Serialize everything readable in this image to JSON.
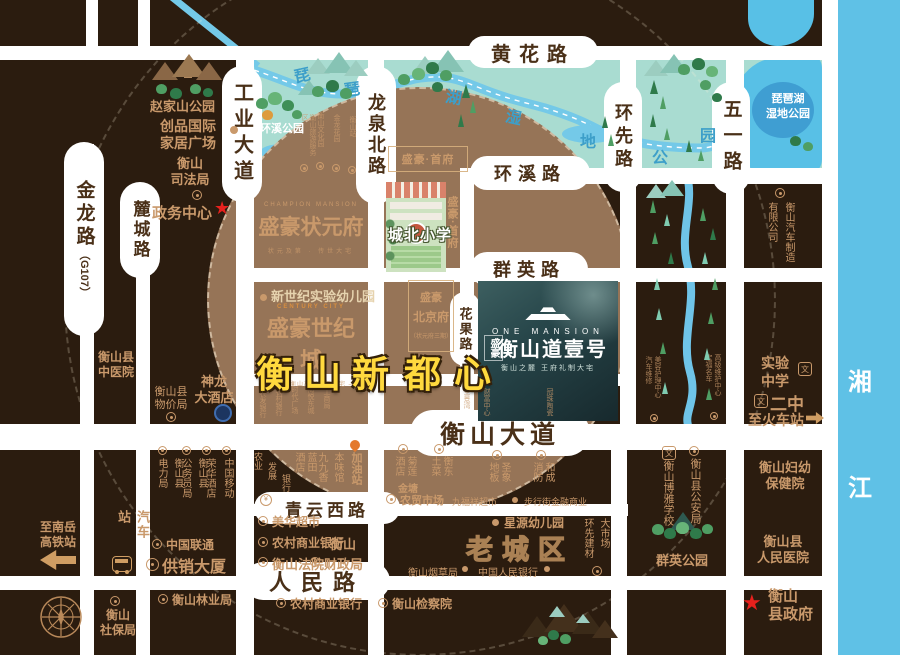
{
  "colors": {
    "bg": "#2b1c0f",
    "road": "#ffffff",
    "disc": "#967457",
    "gold": "#c9996b",
    "yellow": "#ffd93e",
    "wetland": "#a9dcd1",
    "river": "#74c9e8",
    "lake": "#58c0e6",
    "xiang": "#5fc1e6",
    "panel": "#1d3438",
    "red": "#e8211d",
    "orange": "#e4792c"
  },
  "roads": {
    "jinlong": "金龙路",
    "jinlong_sub": "（G107）",
    "lucheng": "麓城路",
    "gongye": "工业大道",
    "longquanbei": "龙泉北路",
    "huanxian": "环先路",
    "wuyi": "五一路",
    "huanghua": "黄花路",
    "huanxi": "环溪路",
    "qunying": "群英路",
    "dadao": "衡山大道",
    "qingyunxi": "青云西路",
    "renmin": "人民路",
    "huaguo": "花果路"
  },
  "river_labels": {
    "xiang": "湘",
    "jiang": "江"
  },
  "wetland": {
    "park": "环溪公园",
    "lake_line1": "琵琶湖",
    "lake_line2": "湿地公园",
    "chars": [
      "琵",
      "琶",
      "湖",
      "湿",
      "地",
      "公",
      "园"
    ]
  },
  "headline": {
    "l": "衡山新",
    "r": "都心"
  },
  "properties": {
    "shoufu_box": "盛豪·首府",
    "shoufu_side": "盛豪·首府",
    "champion_en": "CHAMPION MANSION",
    "champion": "盛豪状元府",
    "champion_sub": "状元及第 · 传世大宅",
    "kindergarten": "新世纪实验幼儿园",
    "century_en": "CENTURY CITY",
    "century": "盛豪世纪城",
    "century_sub": "— 献给衡山高端改善大宅 —",
    "beijing_1": "盛豪",
    "beijing_2": "北京府",
    "beijing_3": "（状元府三期）",
    "om_en": "ONE MANSION",
    "om_brand": "盛豪",
    "om_name": "衡山道壹号",
    "om_sub": "衡山之麓 王府礼制大宅",
    "school": "城北小学"
  },
  "poi": {
    "zhaojiashan": "赵家山公园",
    "chuangpin_1": "创品国际",
    "chuangpin_2": "家居广场",
    "sifaju_1": "衡山",
    "sifaju_2": "司法局",
    "zhengwu": "政务中心",
    "zhongyiyuan_1": "衡山县",
    "zhongyiyuan_2": "中医院",
    "wujiaju_1": "衡山县",
    "wujiaju_2": "物价局",
    "shenlong_1": "神龙",
    "shenlong_2": "大酒店",
    "gaotie_1": "至南岳",
    "gaotie_2": "高铁站",
    "qichezhan": "汽车站",
    "dianliju": [
      "衡山县",
      "电力局"
    ],
    "gongwuyuan": [
      "衡山县",
      "公务员局"
    ],
    "ronghua": "荣华酒店",
    "yidong": "中国移动",
    "liantong": "中国联通",
    "gongxiao": "供销大厦",
    "shebaoju_1": "衡山",
    "shebaoju_2": "社保局",
    "linyeju": "衡山林业局",
    "nongye": [
      "农业",
      "发展",
      "银行"
    ],
    "lantian": "蓝田酒店",
    "benwei": "本味馆",
    "jiujiu": "九九香",
    "jiayou": "加油站",
    "julian": "菊莲酒店",
    "hengdong": "衡东土菜",
    "jintang": "金塘",
    "nongmao": "农贸市场",
    "shengxiang": "圣象地板",
    "hecheng": "和成消防",
    "jiufuxiang": "九福祥超市",
    "buxingjie": "步行街金融商业",
    "meihua": "美华超市",
    "nongshang1": "农村商业银行",
    "fayuan": "衡山法院",
    "caizheng_1": "衡山",
    "caizheng_2": "财政局",
    "xingyuan": "星源幼儿园",
    "laochengqu": "老城区",
    "yancaoju": "衡山烟草局",
    "renminyinhang": "中国人民银行",
    "huanxianjiancai": "环先建材",
    "dashichang": "大市场",
    "nongshang2": "农村商业银行",
    "jianchayuan": "衡山检察院",
    "qiche": [
      "衡山汽车制造",
      "有限公司"
    ],
    "shiyan_1": "实验",
    "shiyan_2": "中学",
    "erzhong": "二中",
    "huochezhan": "至火车站",
    "gonganju": "衡山县公安局",
    "boya": "衡山博雅学校",
    "qunying_park": "群英公园",
    "fuyou_1": "衡山妇幼",
    "fuyou_2": "保健院",
    "renmin_hosp_1": "衡山县",
    "renmin_hosp_2": "人民医院",
    "xianzhengfu_1": "衡山",
    "xianzhengfu_2": "县政府"
  },
  "tiny": {
    "top": [
      "衡山旅游服务区",
      "衡山文化园",
      "金龙花园",
      "衡山站"
    ],
    "bank": [
      "农发银行",
      "农村银行",
      "时代广场",
      "海悦东城",
      "工商局"
    ],
    "bank2": [
      "全景湾",
      "财富中心",
      "冠珠陶瓷"
    ],
    "stream_l": [
      "美容护理中心",
      "汽车维修"
    ],
    "stream_r": [
      "高级维护中心",
      "宏福名车"
    ]
  },
  "icons": {
    "star": "★",
    "wen": "文",
    "yuan": "¥"
  }
}
